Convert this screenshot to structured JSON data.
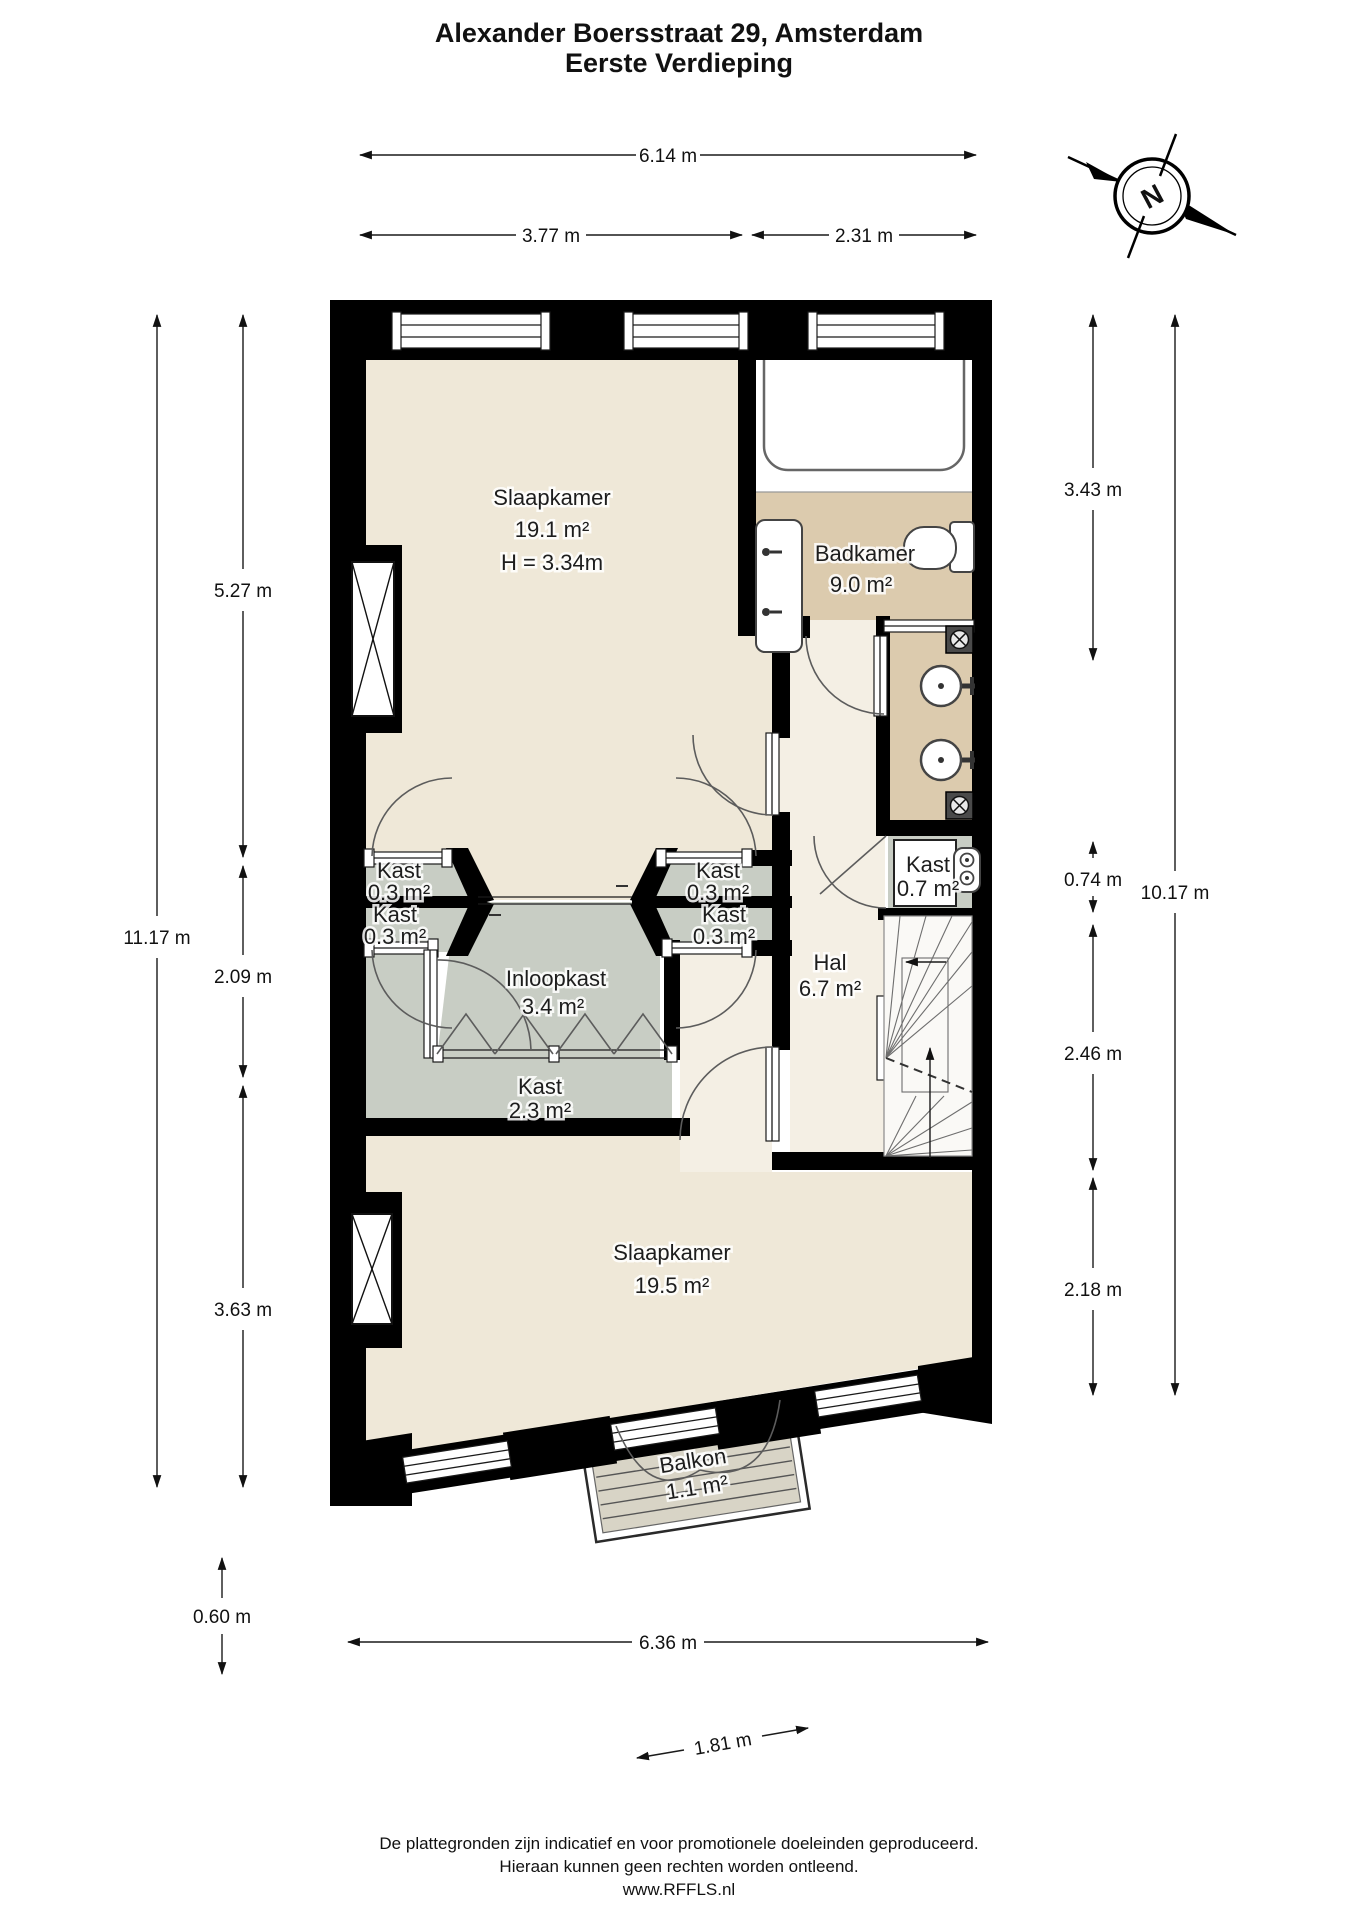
{
  "document": {
    "title_line1": "Alexander Boersstraat 29, Amsterdam",
    "title_line2": "Eerste Verdieping"
  },
  "compass": {
    "label": "N"
  },
  "floorplan": {
    "rooms": [
      {
        "name": "Slaapkamer",
        "area": "19.1 m²",
        "note": "H = 3.34m"
      },
      {
        "name": "Badkamer",
        "area": "9.0 m²"
      },
      {
        "name": "Kast",
        "area": "0.3 m²"
      },
      {
        "name": "Kast",
        "area": "0.3 m²"
      },
      {
        "name": "Kast",
        "area": "0.3 m²"
      },
      {
        "name": "Kast",
        "area": "0.3 m²"
      },
      {
        "name": "Inloopkast",
        "area": "3.4 m²"
      },
      {
        "name": "Kast",
        "area": "2.3 m²"
      },
      {
        "name": "Kast",
        "area": "0.7 m²"
      },
      {
        "name": "Hal",
        "area": "6.7 m²"
      },
      {
        "name": "Slaapkamer",
        "area": "19.5 m²"
      },
      {
        "name": "Balkon",
        "area": "1.1 m²"
      }
    ]
  },
  "dimensions": {
    "top": [
      "6.14 m",
      "3.77 m",
      "2.31 m"
    ],
    "left": [
      "11.17 m",
      "5.27 m",
      "2.09 m",
      "3.63 m",
      "0.60 m"
    ],
    "right": [
      "3.43 m",
      "0.74 m",
      "2.46 m",
      "2.18 m",
      "10.17 m"
    ],
    "bottom": [
      "6.36 m",
      "1.81 m"
    ]
  },
  "footer": {
    "line1": "De plattegronden zijn indicatief en voor promotionele doeleinden geproduceerd.",
    "line2": "Hieraan kunnen geen rechten worden ontleend.",
    "line3": "www.RFFLS.nl"
  },
  "colors": {
    "wall": "#000000",
    "bedroom_floor": "#EFE8D8",
    "hall_floor": "#F4EFE4",
    "bath_floor": "#DCCBAE",
    "closet_floor": "#C8CDC4",
    "tub_zone": "#FFFFFF",
    "stairs_floor": "#FAF9F6",
    "balcony_deck": "#D8D4C6",
    "dimension_line": "#1A1A1A"
  }
}
